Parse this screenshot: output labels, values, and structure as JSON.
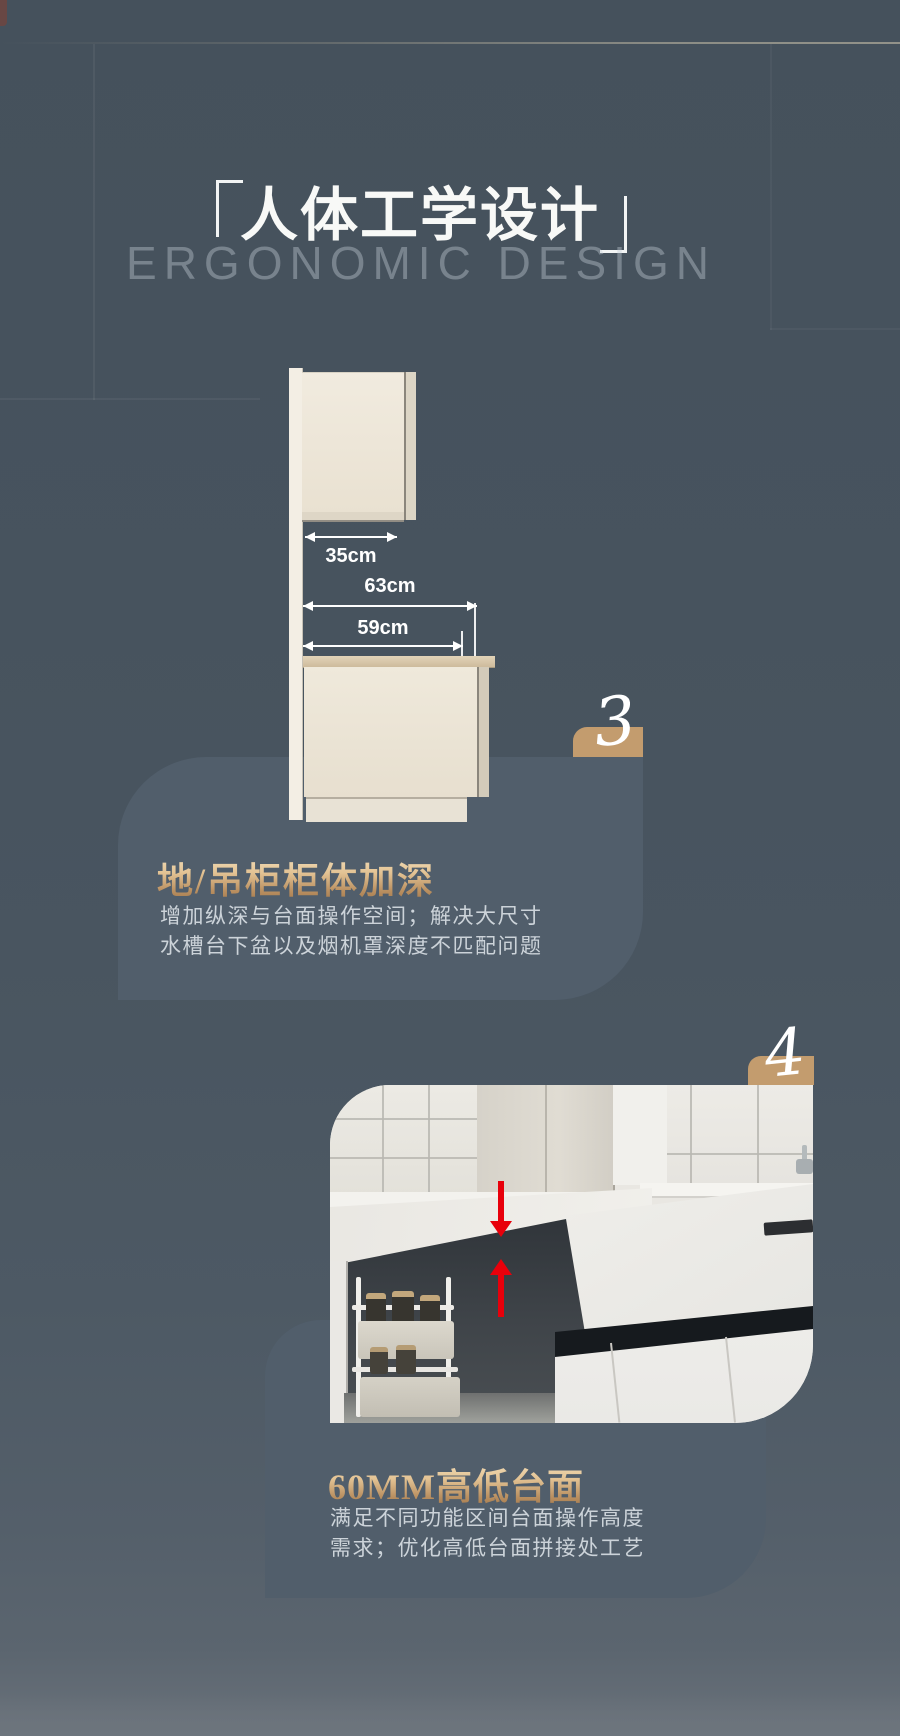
{
  "page": {
    "background_color": "#47535e",
    "accent_gold": "#c39c6e",
    "arrow_red": "#e8000b",
    "card_color": "#515e6b"
  },
  "header": {
    "bracket_left": "「",
    "title": "人体工学设计",
    "bracket_right": "」",
    "subtitle": "ERGONOMIC DESIGN"
  },
  "diagram": {
    "dim_top": "35cm",
    "dim_mid": "63cm",
    "dim_bottom": "59cm"
  },
  "sections": {
    "three": {
      "number": "3",
      "heading": "地/吊柜柜体加深",
      "body_line1": "增加纵深与台面操作空间；解决大尺寸",
      "body_line2": "水槽台下盆以及烟机罩深度不匹配问题"
    },
    "four": {
      "number": "4",
      "heading": "60MM高低台面",
      "body_line1": "满足不同功能区间台面操作高度",
      "body_line2": "需求；优化高低台面拼接处工艺"
    }
  }
}
